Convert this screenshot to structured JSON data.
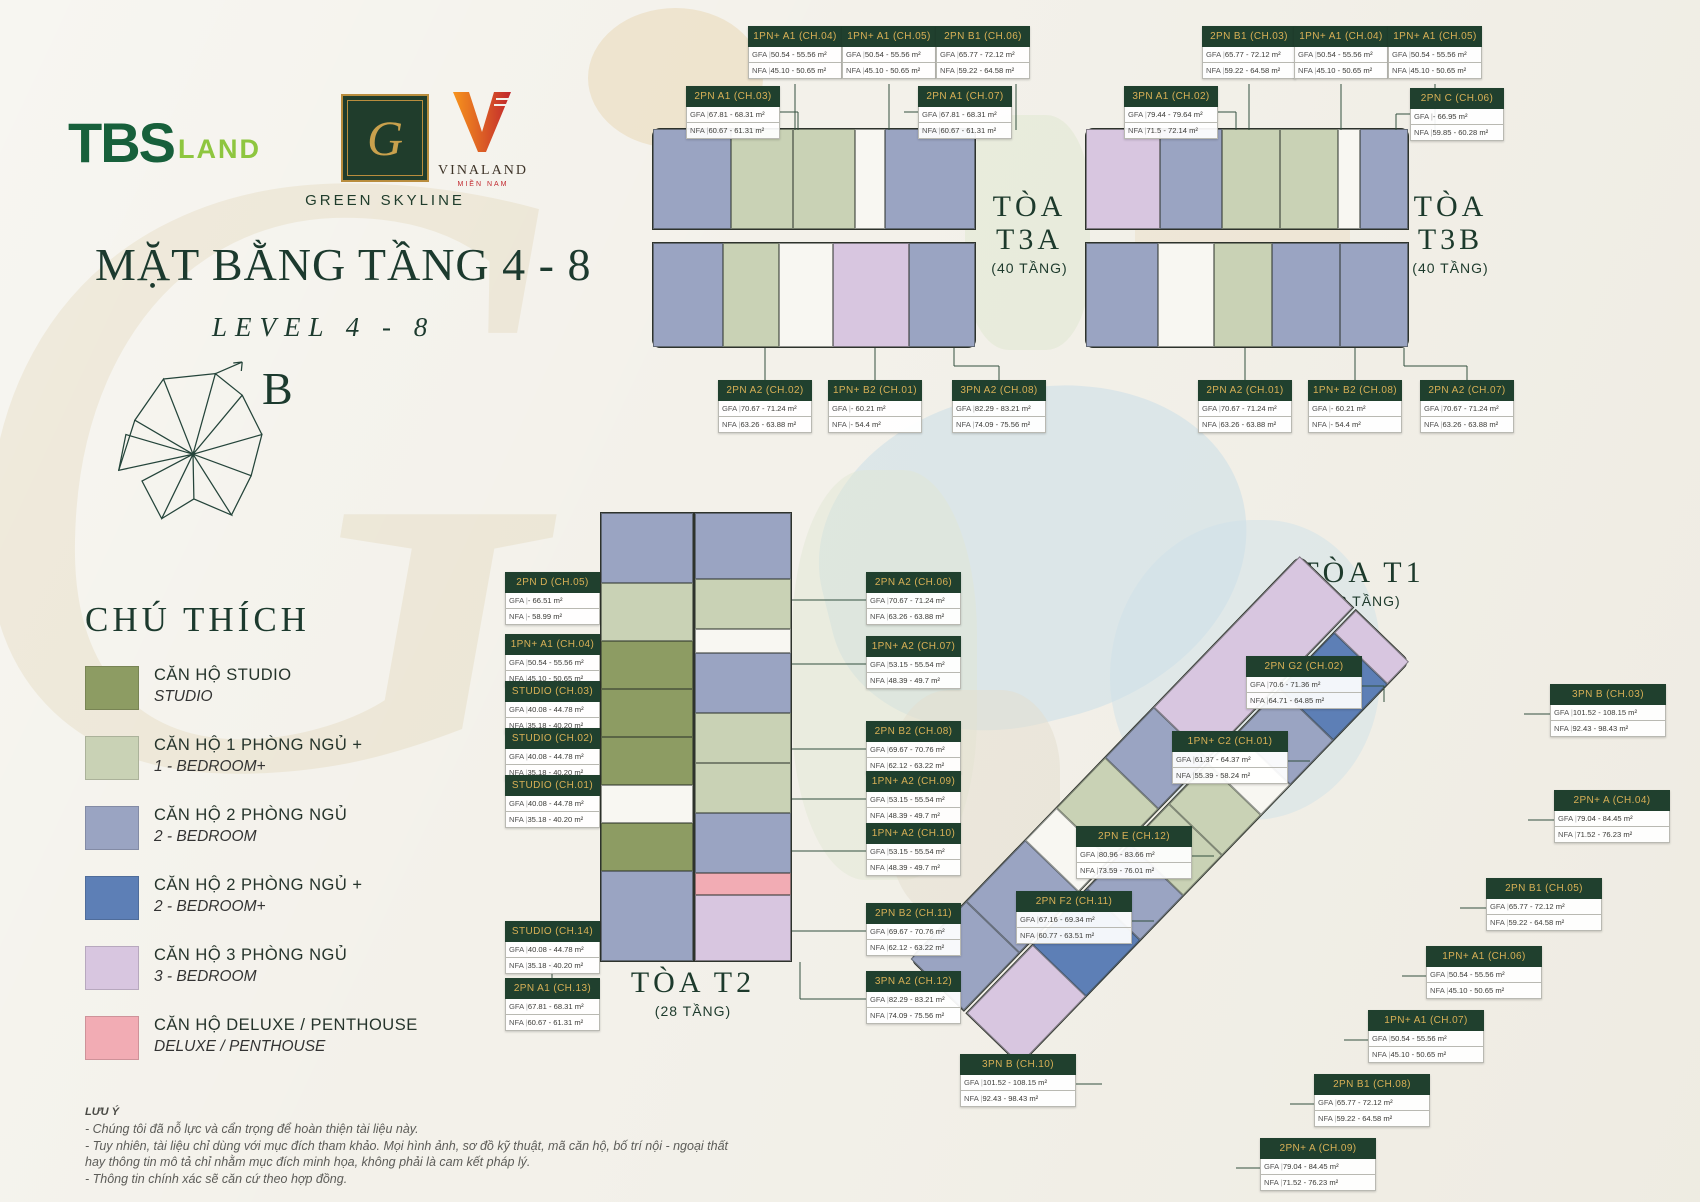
{
  "header": {
    "logos": {
      "tbs": {
        "part1": "TBS",
        "part2": "LAND"
      },
      "green_skyline": {
        "monogram": "G",
        "label": "GREEN SKYLINE"
      },
      "vinaland": {
        "label": "VINALAND",
        "sub": "MIỀN NAM"
      }
    }
  },
  "title": {
    "main": "MẶT BẰNG TẦNG 4 - 8",
    "sub": "LEVEL 4 - 8",
    "compass_label": "B"
  },
  "badge_labels": {
    "gfa": "GFA",
    "nfa": "NFA"
  },
  "colors": {
    "studio": "#8d9c63",
    "br1": "#c9d2b5",
    "br2": "#9aa4c2",
    "br2p": "#5d7fb6",
    "br3": "#d8c6e0",
    "deluxe": "#f2acb4",
    "core": "#f8f7f2",
    "badge_header": "#20402e",
    "badge_gold": "#d8b056",
    "heading_green": "#1c3a2e"
  },
  "legend": {
    "title": "CHÚ THÍCH",
    "items": [
      {
        "color": "#8d9c63",
        "vi": "CĂN HỘ STUDIO",
        "en": "STUDIO"
      },
      {
        "color": "#c9d2b5",
        "vi": "CĂN HỘ 1 PHÒNG NGỦ +",
        "en": "1 - BEDROOM+"
      },
      {
        "color": "#9aa4c2",
        "vi": "CĂN HỘ 2 PHÒNG NGỦ",
        "en": "2 - BEDROOM"
      },
      {
        "color": "#5d7fb6",
        "vi": "CĂN HỘ 2 PHÒNG NGỦ +",
        "en": "2 - BEDROOM+"
      },
      {
        "color": "#d8c6e0",
        "vi": "CĂN HỘ 3 PHÒNG NGỦ",
        "en": "3 - BEDROOM"
      },
      {
        "color": "#f2acb4",
        "vi": "CĂN HỘ DELUXE / PENTHOUSE",
        "en": "DELUXE / PENTHOUSE"
      }
    ]
  },
  "towers": [
    {
      "name": "TÒA T3A",
      "floors": "(40 TẦNG)",
      "units": [
        {
          "code": "1PN+ A1 (CH.04)",
          "gfa": "50.54 - 55.56 m²",
          "nfa": "45.10 - 50.65 m²"
        },
        {
          "code": "1PN+ A1 (CH.05)",
          "gfa": "50.54 - 55.56 m²",
          "nfa": "45.10 - 50.65 m²"
        },
        {
          "code": "2PN B1 (CH.06)",
          "gfa": "65.77 - 72.12 m²",
          "nfa": "59.22 - 64.58 m²"
        },
        {
          "code": "2PN A1 (CH.03)",
          "gfa": "67.81 - 68.31 m²",
          "nfa": "60.67 - 61.31 m²"
        },
        {
          "code": "2PN A1 (CH.07)",
          "gfa": "67.81 - 68.31 m²",
          "nfa": "60.67 - 61.31 m²"
        },
        {
          "code": "2PN A2 (CH.02)",
          "gfa": "70.67 - 71.24 m²",
          "nfa": "63.26 - 63.88 m²"
        },
        {
          "code": "1PN+ B2 (CH.01)",
          "gfa": "- 60.21 m²",
          "nfa": "- 54.4 m²"
        },
        {
          "code": "3PN A2 (CH.08)",
          "gfa": "82.29 - 83.21 m²",
          "nfa": "74.09 - 75.56 m²"
        }
      ]
    },
    {
      "name": "TÒA T3B",
      "floors": "(40 TẦNG)",
      "units": [
        {
          "code": "2PN B1 (CH.03)",
          "gfa": "65.77 - 72.12 m²",
          "nfa": "59.22 - 64.58 m²"
        },
        {
          "code": "1PN+ A1 (CH.04)",
          "gfa": "50.54 - 55.56 m²",
          "nfa": "45.10 - 50.65 m²"
        },
        {
          "code": "1PN+ A1 (CH.05)",
          "gfa": "50.54 - 55.56 m²",
          "nfa": "45.10 - 50.65 m²"
        },
        {
          "code": "3PN A1 (CH.02)",
          "gfa": "79.44 - 79.64 m²",
          "nfa": "71.5 - 72.14 m²"
        },
        {
          "code": "2PN C (CH.06)",
          "gfa": "- 66.95 m²",
          "nfa": "59.85 - 60.28 m²"
        },
        {
          "code": "2PN A2 (CH.01)",
          "gfa": "70.67 - 71.24 m²",
          "nfa": "63.26 - 63.88 m²"
        },
        {
          "code": "1PN+ B2 (CH.08)",
          "gfa": "- 60.21 m²",
          "nfa": "- 54.4 m²"
        },
        {
          "code": "2PN A2 (CH.07)",
          "gfa": "70.67 - 71.24 m²",
          "nfa": "63.26 - 63.88 m²"
        }
      ]
    },
    {
      "name": "TÒA T2",
      "floors": "(28 TẦNG)",
      "units": [
        {
          "code": "2PN D (CH.05)",
          "gfa": "- 66.51 m²",
          "nfa": "- 58.99 m²"
        },
        {
          "code": "1PN+ A1 (CH.04)",
          "gfa": "50.54 - 55.56 m²",
          "nfa": "45.10 - 50.65 m²"
        },
        {
          "code": "STUDIO (CH.03)",
          "gfa": "40.08 - 44.78 m²",
          "nfa": "35.18 - 40.20 m²"
        },
        {
          "code": "STUDIO (CH.02)",
          "gfa": "40.08 - 44.78 m²",
          "nfa": "35.18 - 40.20 m²"
        },
        {
          "code": "STUDIO (CH.01)",
          "gfa": "40.08 - 44.78 m²",
          "nfa": "35.18 - 40.20 m²"
        },
        {
          "code": "STUDIO (CH.14)",
          "gfa": "40.08 - 44.78 m²",
          "nfa": "35.18 - 40.20 m²"
        },
        {
          "code": "2PN A1 (CH.13)",
          "gfa": "67.81 - 68.31 m²",
          "nfa": "60.67 - 61.31 m²"
        },
        {
          "code": "2PN A2 (CH.06)",
          "gfa": "70.67 - 71.24 m²",
          "nfa": "63.26 - 63.88 m²"
        },
        {
          "code": "1PN+ A2 (CH.07)",
          "gfa": "53.15 - 55.54 m²",
          "nfa": "48.39 - 49.7 m²"
        },
        {
          "code": "2PN B2 (CH.08)",
          "gfa": "69.67 - 70.76 m²",
          "nfa": "62.12 - 63.22 m²"
        },
        {
          "code": "1PN+ A2 (CH.09)",
          "gfa": "53.15 - 55.54 m²",
          "nfa": "48.39 - 49.7 m²"
        },
        {
          "code": "1PN+ A2 (CH.10)",
          "gfa": "53.15 - 55.54 m²",
          "nfa": "48.39 - 49.7 m²"
        },
        {
          "code": "2PN B2 (CH.11)",
          "gfa": "69.67 - 70.76 m²",
          "nfa": "62.12 - 63.22 m²"
        },
        {
          "code": "3PN A2 (CH.12)",
          "gfa": "82.29 - 83.21 m²",
          "nfa": "74.09 - 75.56 m²"
        }
      ]
    },
    {
      "name": "TÒA T1",
      "floors": "(28 TẦNG)",
      "units": [
        {
          "code": "2PN G2 (CH.02)",
          "gfa": "70.6 - 71.36 m²",
          "nfa": "64.71 - 64.85 m²"
        },
        {
          "code": "1PN+ C2 (CH.01)",
          "gfa": "61.37 - 64.37 m²",
          "nfa": "55.39 - 58.24 m²"
        },
        {
          "code": "2PN E (CH.12)",
          "gfa": "80.96 - 83.66 m²",
          "nfa": "73.59 - 76.01 m²"
        },
        {
          "code": "2PN F2 (CH.11)",
          "gfa": "67.16 - 69.34 m²",
          "nfa": "60.77 - 63.51 m²"
        },
        {
          "code": "3PN B (CH.10)",
          "gfa": "101.52 - 108.15 m²",
          "nfa": "92.43 - 98.43 m²"
        },
        {
          "code": "3PN B (CH.03)",
          "gfa": "101.52 - 108.15 m²",
          "nfa": "92.43 - 98.43 m²"
        },
        {
          "code": "2PN+ A (CH.04)",
          "gfa": "79.04 - 84.45 m²",
          "nfa": "71.52 - 76.23 m²"
        },
        {
          "code": "2PN B1 (CH.05)",
          "gfa": "65.77 - 72.12 m²",
          "nfa": "59.22 - 64.58 m²"
        },
        {
          "code": "1PN+ A1 (CH.06)",
          "gfa": "50.54 - 55.56 m²",
          "nfa": "45.10 - 50.65 m²"
        },
        {
          "code": "1PN+ A1 (CH.07)",
          "gfa": "50.54 - 55.56 m²",
          "nfa": "45.10 - 50.65 m²"
        },
        {
          "code": "2PN B1 (CH.08)",
          "gfa": "65.77 - 72.12 m²",
          "nfa": "59.22 - 64.58 m²"
        },
        {
          "code": "2PN+ A (CH.09)",
          "gfa": "79.04 - 84.45 m²",
          "nfa": "71.52 - 76.23 m²"
        }
      ]
    }
  ],
  "notes": {
    "title": "LƯU Ý",
    "lines": [
      "- Chúng tôi đã nỗ lực và cẩn trọng để hoàn thiện tài liệu này.",
      "- Tuy nhiên, tài liệu chỉ dùng với mục đích tham khảo. Mọi hình ảnh, sơ đồ kỹ thuật, mã căn hộ, bố trí nội - ngoại thất hay thông tin mô tả chỉ nhằm mục đích minh họa, không phải là cam kết pháp lý.",
      "- Thông tin chính xác sẽ căn cứ theo hợp đồng."
    ]
  }
}
